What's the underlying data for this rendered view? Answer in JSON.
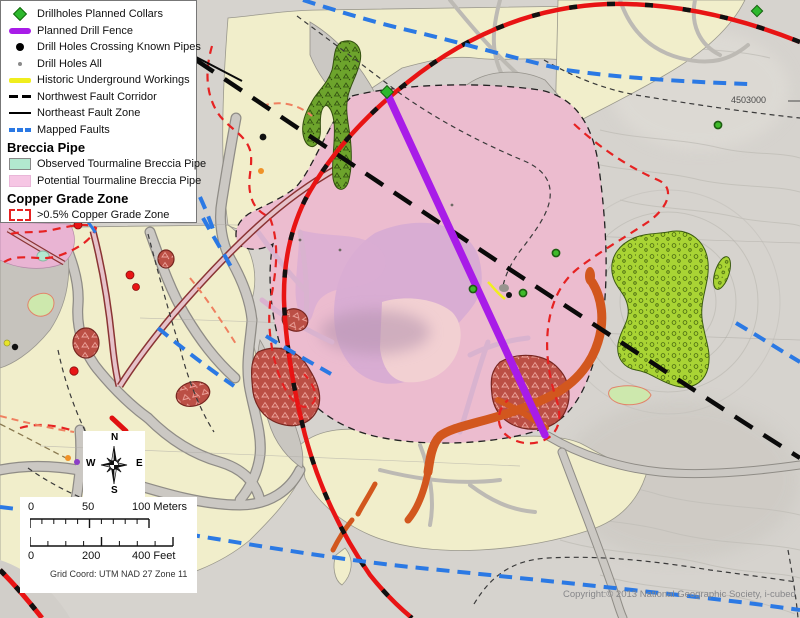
{
  "legend": {
    "items": [
      {
        "label": "Drillholes Planned Collars"
      },
      {
        "label": "Planned Drill Fence"
      },
      {
        "label": "Drill Holes Crossing Known Pipes"
      },
      {
        "label": "Drill Holes All"
      },
      {
        "label": "Historic Underground Workings"
      },
      {
        "label": "Northwest Fault Corridor"
      },
      {
        "label": "Northeast Fault Zone"
      },
      {
        "label": "Mapped Faults"
      }
    ],
    "breccia_header": "Breccia Pipe",
    "breccia_items": [
      {
        "label": "Observed Tourmaline Breccia Pipe"
      },
      {
        "label": "Potential Tourmaline Breccia Pipe"
      }
    ],
    "copper_header": "Copper Grade Zone",
    "copper_items": [
      {
        "label": ">0.5% Copper Grade Zone"
      }
    ]
  },
  "compass": {
    "north": "N",
    "east": "E",
    "south": "S",
    "west": "W"
  },
  "scale_bar": {
    "meters": {
      "zero": "0",
      "mid": "50",
      "end": "100 Meters"
    },
    "feet": {
      "zero": "0",
      "mid": "200",
      "end": "400 Feet"
    },
    "grid_coord": "Grid Coord: UTM NAD 27 Zone 11"
  },
  "map": {
    "grid_northing_label": "4503000",
    "copyright": "Copyright:© 2013 National Geographic Society, i-cubed"
  },
  "colors": {
    "planned_fence": "#a81ce8",
    "planned_collar": "#2db82d",
    "mapped_fault": "#2b79e4",
    "copper_zone": "#e62222",
    "observed_pipe": "#b2e8cf",
    "potential_pipe": "#ecbccf",
    "historic_workings": "#f0ee1e"
  }
}
